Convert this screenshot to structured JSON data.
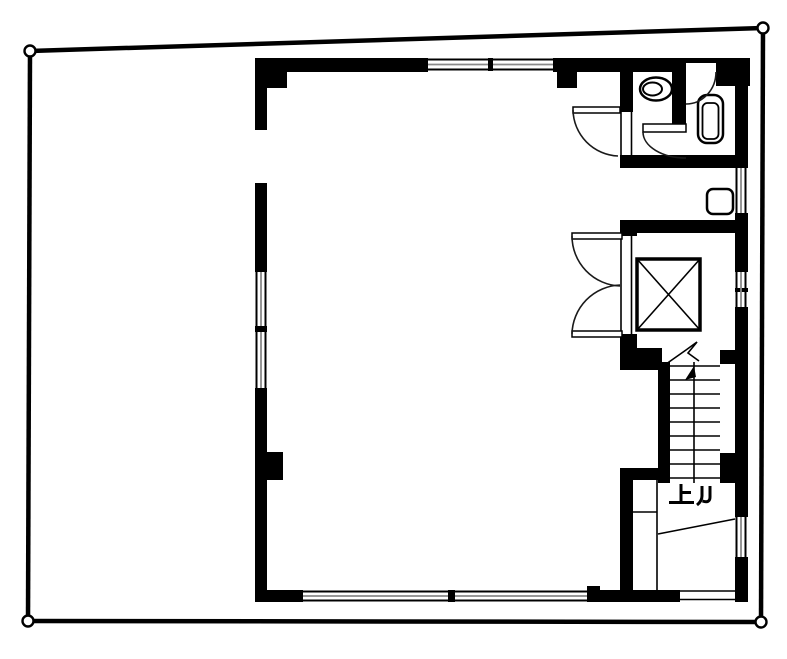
{
  "floor_plan": {
    "kind": "building-floor-plan",
    "stair_label": "上ル",
    "colors": {
      "wall": "#000000",
      "background": "#ffffff",
      "window_glazing": "#8a8a8a"
    },
    "fixtures": [
      "toilet",
      "water-heater-tank",
      "hand-wash-sink",
      "elevator-car",
      "staircase",
      "double-swing-door",
      "swing-door",
      "windows",
      "entrance-opening",
      "property-boundary-markers"
    ]
  }
}
